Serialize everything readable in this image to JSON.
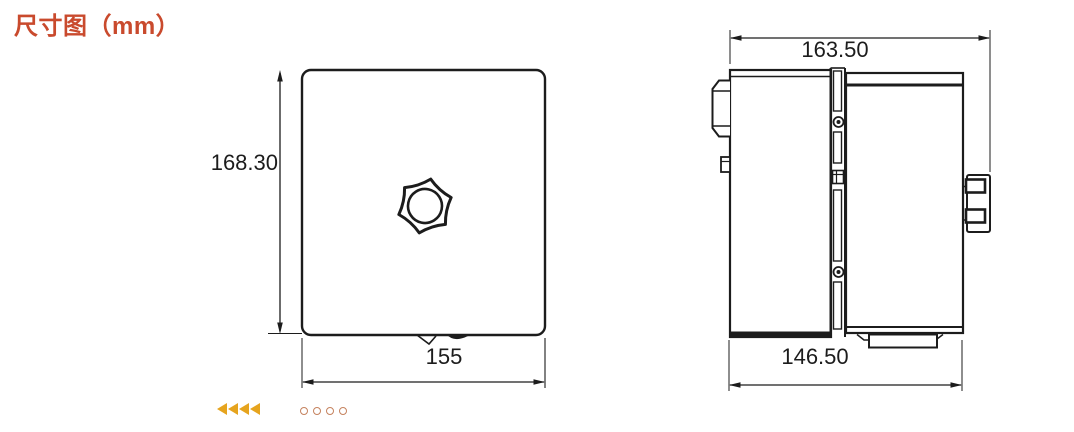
{
  "title": {
    "text": "尺寸图（mm）",
    "color": "#c94a2d"
  },
  "views": {
    "front": {
      "name": "front-view",
      "dimensions": {
        "height_mm": "168.30",
        "width_mm": "155"
      }
    },
    "side": {
      "name": "side-view",
      "dimensions": {
        "overall_depth_mm": "163.50",
        "body_depth_mm": "146.50"
      }
    }
  },
  "pagination": {
    "arrow_count": 4,
    "dot_count": 4,
    "arrow_color": "#e6a41e",
    "dot_color": "#c5825e"
  }
}
